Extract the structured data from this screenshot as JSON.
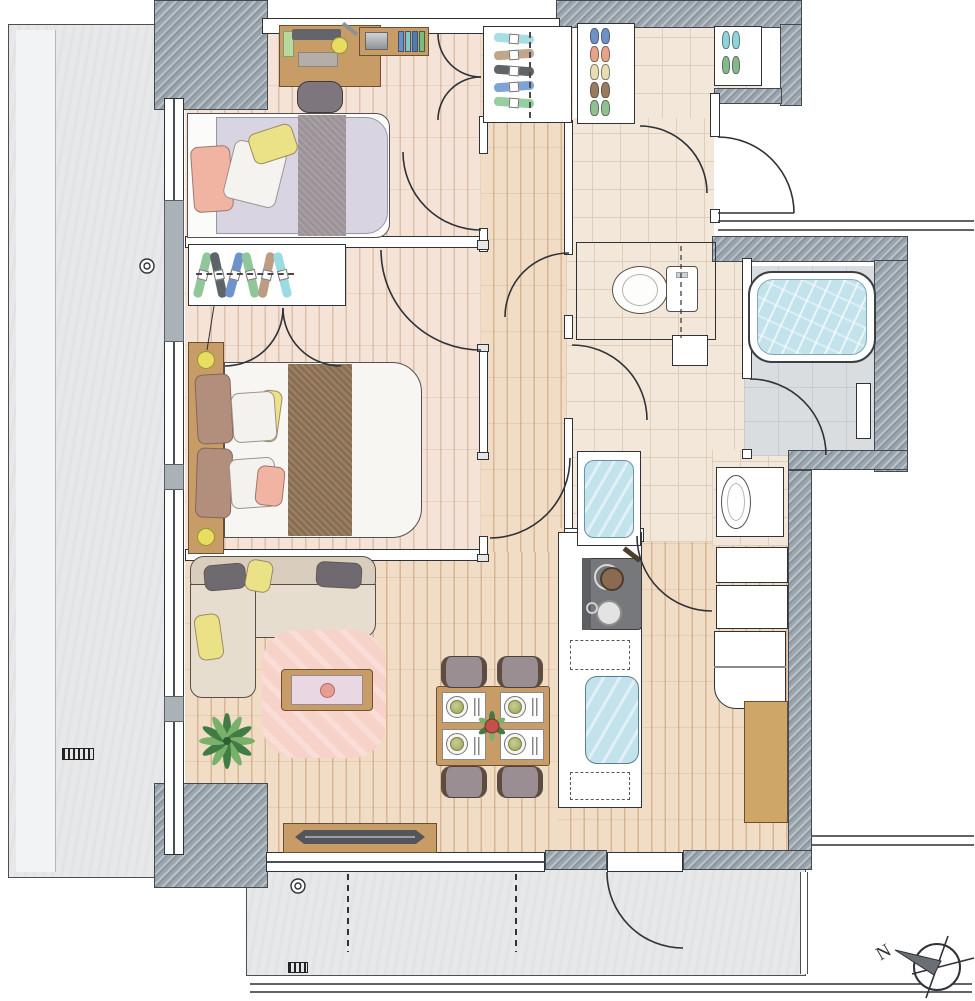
{
  "compass": {
    "label": "N"
  },
  "palette": {
    "wall-line": "#2f3237",
    "wall-hatch": "#9aa5ae",
    "balcony": "#e7e8e9",
    "wood-bedroom": "#f4e3d6",
    "wood-bedroom-line": "#dcc0ab",
    "wood-hall": "#f1dcc5",
    "wood-hall-line": "#d6b693",
    "tile": "#f2e7d8",
    "tile-line": "#ddcfb9",
    "bath-floor": "#d9dde0",
    "water": "#c2e2ec",
    "furniture-wood": "#c89c66",
    "rug": "#f7d2c9",
    "sofa": "#d9cdbd",
    "sofa-cushion": "#e7ddcf",
    "mattress-single": "#d8d4e2",
    "bed-runner-single": "#9c9399",
    "bed-runner-double": "#8a6e51",
    "pillow-pink": "#f1b3a2",
    "pillow-yellow": "#ebe288",
    "pillow-brown": "#b28f7d",
    "pillow-gray": "#6f6a70",
    "chair": "#9b8e92",
    "appliance-dark": "#76787b",
    "lamp-yellow": "#e8dc62",
    "plant-dark": "#417c44",
    "plant-light": "#79b06a"
  },
  "bedroom_closet": {
    "hangers": [
      "#8fc79a",
      "#5f6468",
      "#6d93cf",
      "#8fc79a",
      "#bd9c84",
      "#9adce2"
    ]
  },
  "entry_closet": {
    "hangers": [
      "#aadde3",
      "#c2a68c",
      "#5f6468",
      "#7fa3d7",
      "#96cf9d"
    ]
  },
  "shoe_rack": {
    "pairs": [
      "#6f8fc8",
      "#e8a287",
      "#e6ddb0",
      "#9b7b5e",
      "#8fbf92"
    ]
  },
  "slipper_rack": {
    "pairs": [
      "#8fd4d8",
      "#86b98c"
    ]
  },
  "bookshelf": {
    "books": [
      "#6b8fca",
      "#7fc9cd",
      "#4f7ab8",
      "#79bd7e"
    ]
  },
  "dining": {
    "chairs": 4,
    "place_settings": 4
  },
  "rooms": [
    {
      "id": "bedroom-a",
      "furniture": [
        "desk",
        "desk-chair",
        "desk-lamp",
        "bookshelf",
        "single-bed",
        "closet"
      ]
    },
    {
      "id": "bedroom-b",
      "furniture": [
        "double-bed",
        "headboard-lamps",
        "closet"
      ]
    },
    {
      "id": "living-dining",
      "furniture": [
        "corner-sofa",
        "rug",
        "coffee-table",
        "plant",
        "tv-board",
        "dining-table",
        "dining-chairs"
      ]
    },
    {
      "id": "kitchen",
      "furniture": [
        "gas-stove",
        "sink",
        "counter",
        "refrigerator",
        "cabinets"
      ]
    },
    {
      "id": "washroom",
      "furniture": [
        "vanity-basin",
        "washing-machine-pan"
      ]
    },
    {
      "id": "toilet",
      "furniture": [
        "toilet"
      ]
    },
    {
      "id": "bathroom",
      "furniture": [
        "bathtub",
        "bath-shelf"
      ]
    },
    {
      "id": "entrance",
      "furniture": [
        "shoe-rack",
        "slipper-rack",
        "coat-closet"
      ]
    },
    {
      "id": "balcony-west",
      "furniture": [
        "floor-drain"
      ]
    },
    {
      "id": "balcony-south",
      "furniture": [
        "floor-drain",
        "partition-lines"
      ]
    }
  ]
}
